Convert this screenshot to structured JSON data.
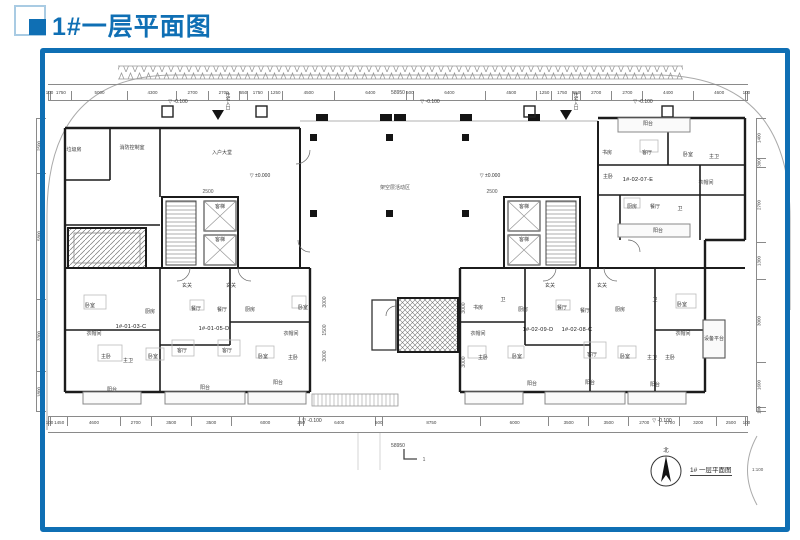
{
  "header": {
    "title": "1#一层平面图"
  },
  "footer": {
    "north_label": "北",
    "caption": "1# 一层平面图",
    "scale": "1:100"
  },
  "colors": {
    "accent": "#0f6fb4",
    "wall": "#1c1c1c",
    "thin_line": "#999999"
  },
  "dimensions": {
    "total_top": "58950",
    "total_bottom": "58950",
    "top": [
      "100",
      "1750",
      "5000",
      "4300",
      "2700",
      "2700",
      "650",
      "1750",
      "1250",
      "4500",
      "6400",
      "500",
      "6400",
      "4500",
      "1250",
      "1750",
      "650",
      "2700",
      "2700",
      "4400",
      "4600",
      "100"
    ],
    "bottom": [
      "100",
      "1450",
      "4600",
      "2700",
      "3500",
      "3500",
      "6000",
      "250",
      "6400",
      "500",
      "8750",
      "6000",
      "3500",
      "3500",
      "2700",
      "1700",
      "3200",
      "2500",
      "100"
    ],
    "right": [
      "1400",
      "300",
      "2700",
      "1300",
      "3000",
      "1600",
      "100"
    ],
    "left": [
      "2500",
      "5800",
      "3300",
      "1800"
    ]
  },
  "units": [
    {
      "t": "1#-01-03-C",
      "x": 131,
      "y": 327
    },
    {
      "t": "1#-01-05-D",
      "x": 214,
      "y": 329
    },
    {
      "t": "1#-02-09-D",
      "x": 538,
      "y": 330
    },
    {
      "t": "1#-02-08-C",
      "x": 577,
      "y": 330
    },
    {
      "t": "1#-02-07-E",
      "x": 638,
      "y": 180
    }
  ],
  "rooms": [
    {
      "t": "卧室",
      "x": 90,
      "y": 306
    },
    {
      "t": "厨房",
      "x": 150,
      "y": 312
    },
    {
      "t": "衣帽间",
      "x": 94,
      "y": 334
    },
    {
      "t": "主卧",
      "x": 106,
      "y": 357
    },
    {
      "t": "主卫",
      "x": 128,
      "y": 361
    },
    {
      "t": "卧室",
      "x": 153,
      "y": 357
    },
    {
      "t": "阳台",
      "x": 112,
      "y": 390
    },
    {
      "t": "玄关",
      "x": 187,
      "y": 286
    },
    {
      "t": "餐厅",
      "x": 196,
      "y": 309
    },
    {
      "t": "客厅",
      "x": 182,
      "y": 351
    },
    {
      "t": "阳台",
      "x": 205,
      "y": 388
    },
    {
      "t": "玄关",
      "x": 231,
      "y": 286
    },
    {
      "t": "餐厅",
      "x": 222,
      "y": 310
    },
    {
      "t": "厨房",
      "x": 250,
      "y": 310
    },
    {
      "t": "客厅",
      "x": 227,
      "y": 351
    },
    {
      "t": "卧室",
      "x": 263,
      "y": 357
    },
    {
      "t": "衣帽间",
      "x": 291,
      "y": 334
    },
    {
      "t": "主卧",
      "x": 293,
      "y": 358
    },
    {
      "t": "卧室",
      "x": 303,
      "y": 308
    },
    {
      "t": "阳台",
      "x": 278,
      "y": 383
    },
    {
      "t": "书房",
      "x": 478,
      "y": 308
    },
    {
      "t": "卫",
      "x": 503,
      "y": 300
    },
    {
      "t": "衣帽间",
      "x": 478,
      "y": 334
    },
    {
      "t": "主卧",
      "x": 483,
      "y": 358
    },
    {
      "t": "卧室",
      "x": 517,
      "y": 357
    },
    {
      "t": "厨房",
      "x": 523,
      "y": 310
    },
    {
      "t": "玄关",
      "x": 550,
      "y": 286
    },
    {
      "t": "餐厅",
      "x": 562,
      "y": 308
    },
    {
      "t": "阳台",
      "x": 532,
      "y": 384
    },
    {
      "t": "餐厅",
      "x": 585,
      "y": 311
    },
    {
      "t": "玄关",
      "x": 602,
      "y": 286
    },
    {
      "t": "厨房",
      "x": 620,
      "y": 310
    },
    {
      "t": "客厅",
      "x": 592,
      "y": 355
    },
    {
      "t": "卧室",
      "x": 625,
      "y": 357
    },
    {
      "t": "阳台",
      "x": 590,
      "y": 383
    },
    {
      "t": "卫",
      "x": 655,
      "y": 300
    },
    {
      "t": "卧室",
      "x": 682,
      "y": 305
    },
    {
      "t": "衣帽间",
      "x": 683,
      "y": 334
    },
    {
      "t": "主卫",
      "x": 652,
      "y": 358
    },
    {
      "t": "主卧",
      "x": 670,
      "y": 358
    },
    {
      "t": "阳台",
      "x": 655,
      "y": 385
    },
    {
      "t": "阳台",
      "x": 648,
      "y": 124
    },
    {
      "t": "书房",
      "x": 607,
      "y": 153
    },
    {
      "t": "客厅",
      "x": 647,
      "y": 153
    },
    {
      "t": "卧室",
      "x": 688,
      "y": 155
    },
    {
      "t": "主卫",
      "x": 714,
      "y": 157
    },
    {
      "t": "主卧",
      "x": 608,
      "y": 177
    },
    {
      "t": "衣帽间",
      "x": 706,
      "y": 183
    },
    {
      "t": "厨房",
      "x": 632,
      "y": 207
    },
    {
      "t": "餐厅",
      "x": 655,
      "y": 207
    },
    {
      "t": "卫",
      "x": 680,
      "y": 209
    },
    {
      "t": "阳台",
      "x": 658,
      "y": 231
    },
    {
      "t": "设备平台",
      "x": 714,
      "y": 339
    },
    {
      "t": "垃圾房",
      "x": 74,
      "y": 150
    },
    {
      "t": "消防控制室",
      "x": 132,
      "y": 148
    },
    {
      "t": "入户大堂",
      "x": 222,
      "y": 153
    },
    {
      "t": "客梯",
      "x": 220,
      "y": 207
    },
    {
      "t": "客梯",
      "x": 220,
      "y": 240
    },
    {
      "t": "客梯",
      "x": 524,
      "y": 207
    },
    {
      "t": "客梯",
      "x": 524,
      "y": 240
    }
  ],
  "levels": [
    {
      "t": "-0.100",
      "x": 178,
      "y": 102
    },
    {
      "t": "-0.100",
      "x": 430,
      "y": 102
    },
    {
      "t": "-0.100",
      "x": 643,
      "y": 102
    },
    {
      "t": "-0.100",
      "x": 312,
      "y": 421
    },
    {
      "t": "-0.100",
      "x": 662,
      "y": 421
    },
    {
      "t": "±0.000",
      "x": 260,
      "y": 176
    },
    {
      "t": "±0.000",
      "x": 490,
      "y": 176
    }
  ],
  "entrances": [
    {
      "t": "住宅入口",
      "x": 228,
      "y": 92
    },
    {
      "t": "住宅入口",
      "x": 576,
      "y": 92
    }
  ],
  "annotations": [
    {
      "t": "架空层活动区",
      "x": 395,
      "y": 188
    },
    {
      "t": "2500",
      "x": 208,
      "y": 192
    },
    {
      "t": "2500",
      "x": 492,
      "y": 192
    },
    {
      "t": "3000",
      "x": 464,
      "y": 308,
      "r": 1
    },
    {
      "t": "3000",
      "x": 464,
      "y": 362,
      "r": 1
    },
    {
      "t": "3000",
      "x": 325,
      "y": 302,
      "r": 1
    },
    {
      "t": "1500",
      "x": 325,
      "y": 330,
      "r": 1
    },
    {
      "t": "3000",
      "x": 325,
      "y": 356,
      "r": 1
    },
    {
      "t": "1",
      "x": 424,
      "y": 460
    }
  ]
}
